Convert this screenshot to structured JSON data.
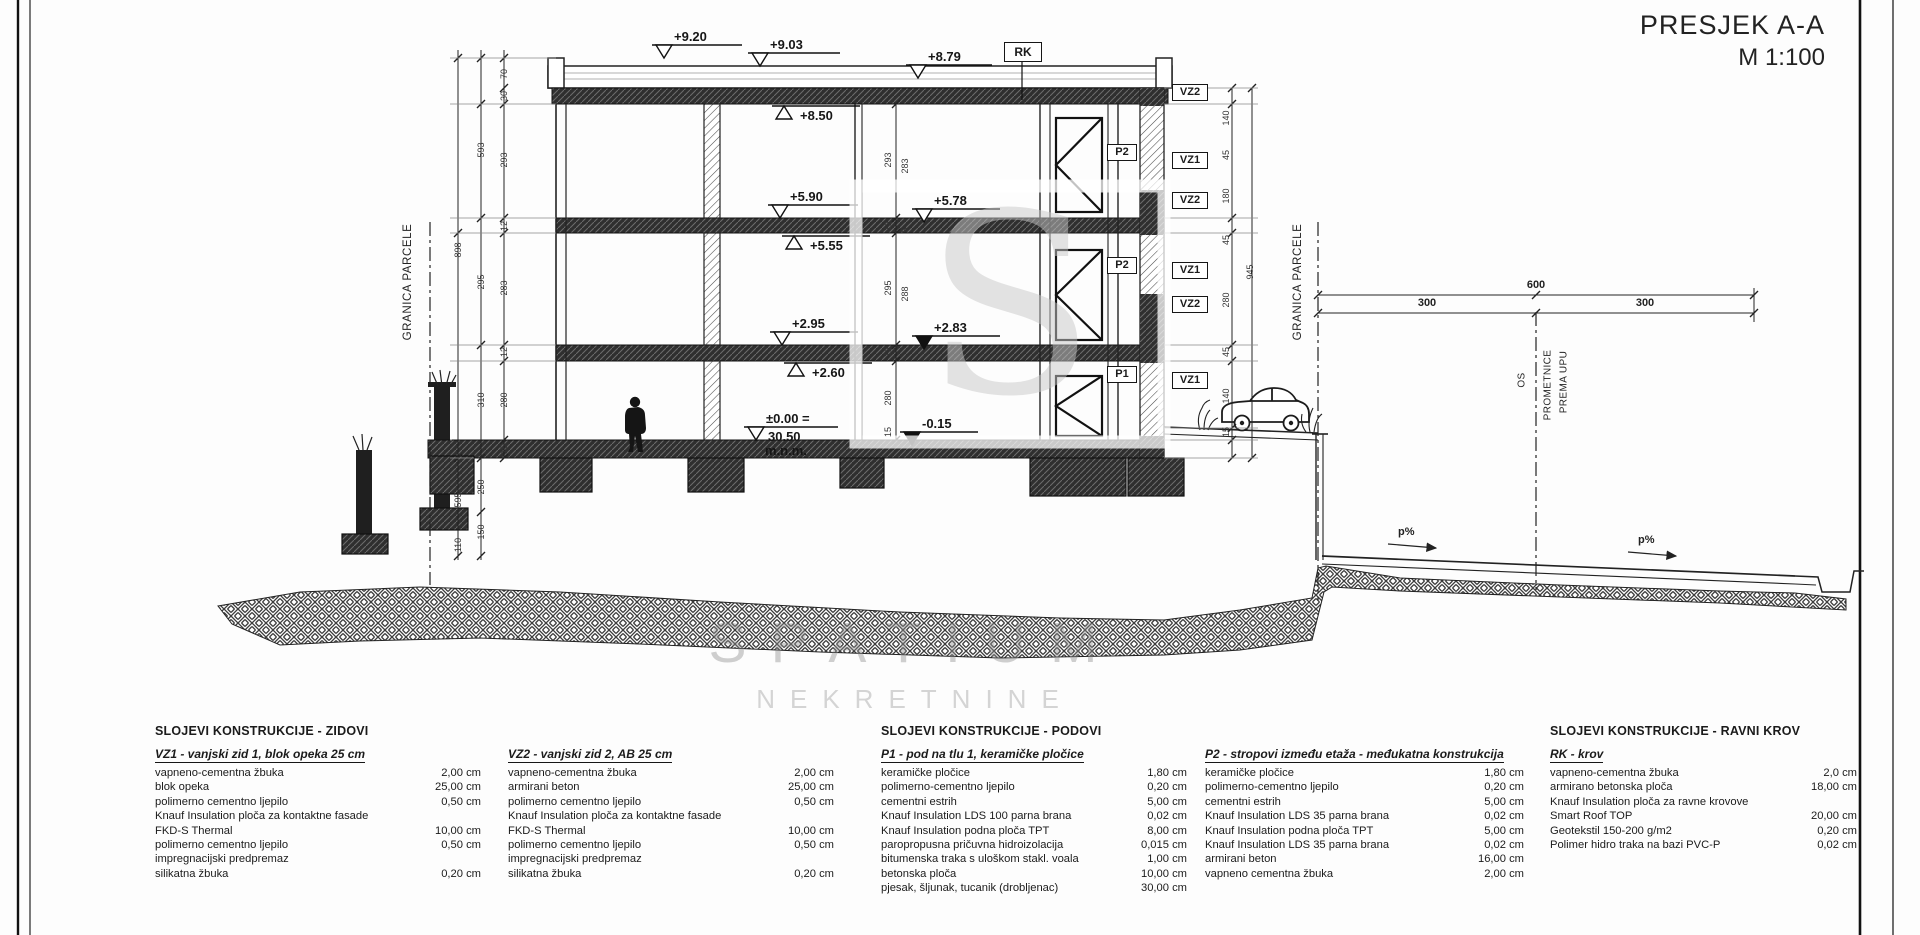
{
  "title": {
    "line1": "PRESJEK A-A",
    "line2": "M 1:100"
  },
  "watermark": {
    "line1": "SPATIUM",
    "line2": "NEKRETNINE",
    "logo_letter": "S"
  },
  "drawing": {
    "boxed_labels": {
      "rk": "RK",
      "p2_upper": "P2",
      "p2_lower": "P2",
      "p1": "P1",
      "vz_stack": [
        "VZ2",
        "VZ1",
        "VZ2",
        "VZ1",
        "VZ2",
        "VZ1"
      ]
    },
    "elevations": {
      "parapet": "+9.20",
      "roof_top": "+9.03",
      "roof_slab": "+8.79",
      "roof_ceiling": "+8.50",
      "floor3": "+5.90",
      "terrace3": "+5.78",
      "ceiling2": "+5.55",
      "floor2": "+2.95",
      "terrace2": "+2.83",
      "ceiling1": "+2.60",
      "ground_line1": "±0.00 =",
      "ground_line2": "30.50",
      "ground_line3": "m.n.m.",
      "entry": "-0.15"
    },
    "boundary_label_left": "GRANICA PARCELE",
    "boundary_label_right": "GRANICA PARCELE",
    "road": {
      "axis_lines": [
        "OS",
        "PROMETNICE",
        "PREMA UPU"
      ],
      "dim_total": "600",
      "dim_left": "300",
      "dim_right": "300",
      "slope_left": "p%",
      "slope_right": "p%"
    },
    "dim_numbers": [
      {
        "t": "70",
        "x": 504,
        "y": 74
      },
      {
        "t": "30",
        "x": 504,
        "y": 96
      },
      {
        "t": "293",
        "x": 504,
        "y": 160
      },
      {
        "t": "12",
        "x": 504,
        "y": 226
      },
      {
        "t": "283",
        "x": 504,
        "y": 288
      },
      {
        "t": "12",
        "x": 504,
        "y": 352
      },
      {
        "t": "280",
        "x": 504,
        "y": 400
      },
      {
        "t": "15",
        "x": 504,
        "y": 449
      },
      {
        "t": "593",
        "x": 481,
        "y": 150
      },
      {
        "t": "295",
        "x": 481,
        "y": 282
      },
      {
        "t": "310",
        "x": 481,
        "y": 400
      },
      {
        "t": "250",
        "x": 481,
        "y": 487
      },
      {
        "t": "150",
        "x": 481,
        "y": 532
      },
      {
        "t": "898",
        "x": 458,
        "y": 250
      },
      {
        "t": "595",
        "x": 458,
        "y": 500
      },
      {
        "t": "110",
        "x": 458,
        "y": 545
      },
      {
        "t": "293",
        "x": 888,
        "y": 160
      },
      {
        "t": "283",
        "x": 905,
        "y": 166
      },
      {
        "t": "12",
        "x": 888,
        "y": 226
      },
      {
        "t": "5",
        "x": 905,
        "y": 230
      },
      {
        "t": "295",
        "x": 888,
        "y": 288
      },
      {
        "t": "288",
        "x": 905,
        "y": 294
      },
      {
        "t": "12",
        "x": 888,
        "y": 352
      },
      {
        "t": "280",
        "x": 888,
        "y": 398
      },
      {
        "t": "15",
        "x": 888,
        "y": 432
      },
      {
        "t": "140",
        "x": 1226,
        "y": 118
      },
      {
        "t": "45",
        "x": 1226,
        "y": 155
      },
      {
        "t": "180",
        "x": 1226,
        "y": 196
      },
      {
        "t": "45",
        "x": 1226,
        "y": 240
      },
      {
        "t": "280",
        "x": 1226,
        "y": 300
      },
      {
        "t": "45",
        "x": 1226,
        "y": 352
      },
      {
        "t": "140",
        "x": 1226,
        "y": 396
      },
      {
        "t": "15",
        "x": 1226,
        "y": 432
      },
      {
        "t": "945",
        "x": 1250,
        "y": 272
      }
    ]
  },
  "specs": [
    {
      "header": "SLOJEVI KONSTRUKCIJE - ZIDOVI",
      "title": "VZ1 - vanjski zid 1, blok opeka 25 cm",
      "rows": [
        [
          "vapneno-cementna žbuka",
          "2,00 cm"
        ],
        [
          "blok opeka",
          "25,00 cm"
        ],
        [
          "polimerno cementno ljepilo",
          "0,50 cm"
        ],
        [
          "Knauf Insulation ploča za kontaktne fasade",
          ""
        ],
        [
          "FKD-S Thermal",
          "10,00 cm"
        ],
        [
          "polimerno cementno ljepilo",
          "0,50 cm"
        ],
        [
          "impregnacijski predpremaz",
          ""
        ],
        [
          "silikatna žbuka",
          "0,20 cm"
        ]
      ]
    },
    {
      "header": "",
      "title": "VZ2 - vanjski zid 2, AB 25 cm",
      "rows": [
        [
          "vapneno-cementna žbuka",
          "2,00 cm"
        ],
        [
          "armirani beton",
          "25,00 cm"
        ],
        [
          "polimerno cementno ljepilo",
          "0,50 cm"
        ],
        [
          "Knauf Insulation ploča za kontaktne fasade",
          ""
        ],
        [
          "FKD-S Thermal",
          "10,00 cm"
        ],
        [
          "polimerno cementno ljepilo",
          "0,50 cm"
        ],
        [
          "impregnacijski predpremaz",
          ""
        ],
        [
          "silikatna žbuka",
          "0,20 cm"
        ]
      ]
    },
    {
      "header": "SLOJEVI KONSTRUKCIJE - PODOVI",
      "title": "P1 - pod na tlu 1, keramičke pločice",
      "rows": [
        [
          "keramičke pločice",
          "1,80 cm"
        ],
        [
          "polimerno-cementno ljepilo",
          "0,20 cm"
        ],
        [
          "cementni estrih",
          "5,00 cm"
        ],
        [
          "Knauf Insulation LDS 100 parna brana",
          "0,02 cm"
        ],
        [
          "Knauf Insulation podna ploča TPT",
          "8,00 cm"
        ],
        [
          "paropropusna pričuvna hidroizolacija",
          "0,015 cm"
        ],
        [
          "bitumenska traka s uloškom stakl. voala",
          "1,00 cm"
        ],
        [
          "betonska ploča",
          "10,00 cm"
        ],
        [
          "pjesak, šljunak, tucanik (drobljenac)",
          "30,00 cm"
        ]
      ]
    },
    {
      "header": "",
      "title": "P2 - stropovi između etaža - međukatna konstrukcija",
      "rows": [
        [
          "keramičke pločice",
          "1,80 cm"
        ],
        [
          "polimerno-cementno ljepilo",
          "0,20 cm"
        ],
        [
          "cementni estrih",
          "5,00 cm"
        ],
        [
          "Knauf Insulation LDS 35 parna brana",
          "0,02 cm"
        ],
        [
          "Knauf Insulation podna ploča TPT",
          "5,00 cm"
        ],
        [
          "Knauf Insulation LDS 35 parna brana",
          "0,02 cm"
        ],
        [
          "armirani beton",
          "16,00 cm"
        ],
        [
          "vapneno cementna žbuka",
          "2,00 cm"
        ]
      ]
    },
    {
      "header": "SLOJEVI KONSTRUKCIJE - RAVNI KROV",
      "title": "RK - krov",
      "rows": [
        [
          "vapneno-cementna žbuka",
          "2,0 cm"
        ],
        [
          "armirano betonska ploča",
          "18,00 cm"
        ],
        [
          "Knauf Insulation ploča za ravne krovove",
          ""
        ],
        [
          "Smart Roof TOP",
          "20,00 cm"
        ],
        [
          "Geotekstil 150-200 g/m2",
          "0,20 cm"
        ],
        [
          "Polimer hidro traka na bazi PVC-P",
          "0,02 cm"
        ]
      ]
    }
  ]
}
